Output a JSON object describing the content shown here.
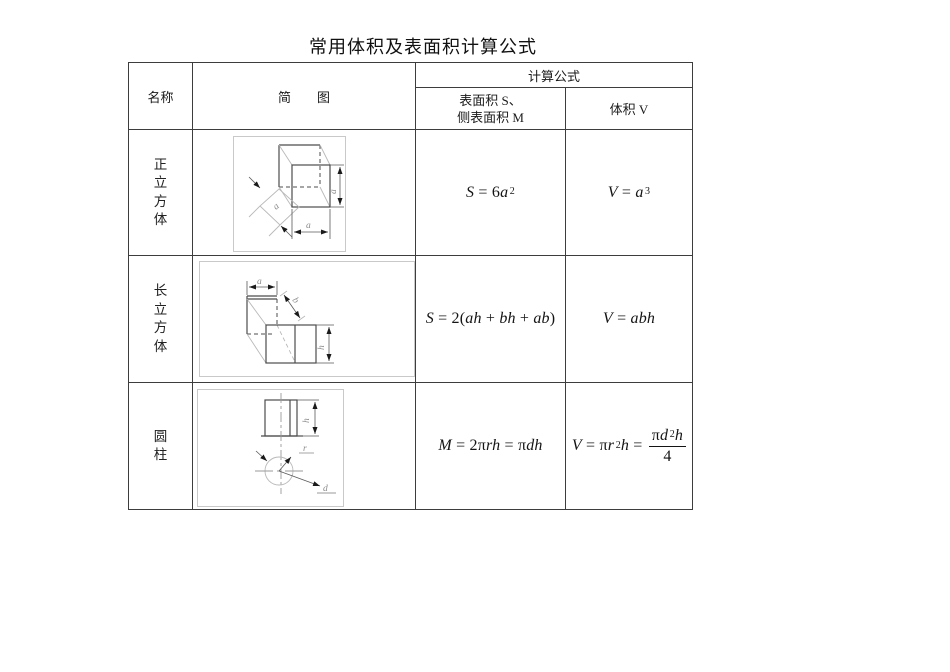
{
  "page": {
    "title": "常用体积及表面积计算公式"
  },
  "colors": {
    "grid_border": "#3d3d3d",
    "frame_border": "#c9c9c9",
    "text": "#1a1a1a"
  },
  "table": {
    "header": {
      "name": "名称",
      "diagram": "简　　图",
      "formula_group": "计算公式",
      "surface_col": "表面积 S、\n侧表面积 M",
      "volume_col": "体积 V"
    },
    "rows": [
      {
        "name": "正\n立\n方\n体",
        "labels": {
          "depth_a": "a",
          "height_a": "a",
          "width_a": "a"
        },
        "surface": [
          {
            "t": "S",
            "i": true
          },
          {
            "t": " = "
          },
          {
            "t": "6"
          },
          {
            "t": "a",
            "i": true
          },
          {
            "t": "2",
            "sup": true
          }
        ],
        "volume": [
          {
            "t": "V",
            "i": true
          },
          {
            "t": " = "
          },
          {
            "t": "a",
            "i": true
          },
          {
            "t": "3",
            "sup": true
          }
        ]
      },
      {
        "name": "长\n立\n方\n体",
        "labels": {
          "a": "a",
          "b": "b",
          "h": "h"
        },
        "surface": [
          {
            "t": "S",
            "i": true
          },
          {
            "t": " = "
          },
          {
            "t": "2("
          },
          {
            "t": "ah",
            "i": true
          },
          {
            "t": " + "
          },
          {
            "t": "bh",
            "i": true
          },
          {
            "t": " + "
          },
          {
            "t": "ab",
            "i": true
          },
          {
            "t": ")"
          }
        ],
        "volume": [
          {
            "t": "V",
            "i": true
          },
          {
            "t": " = "
          },
          {
            "t": "abh",
            "i": true
          }
        ]
      },
      {
        "name": "圆\n柱",
        "labels": {
          "h": "h",
          "r": "r",
          "d": "d"
        },
        "surface": [
          {
            "t": "M",
            "i": true
          },
          {
            "t": " = 2π"
          },
          {
            "t": "rh",
            "i": true
          },
          {
            "t": " = π"
          },
          {
            "t": "dh",
            "i": true
          }
        ],
        "volume": [
          {
            "t": "V",
            "i": true
          },
          {
            "t": " = π"
          },
          {
            "t": "r",
            "i": true
          },
          {
            "t": "2",
            "sup": true
          },
          {
            "t": "h",
            "i": true
          },
          {
            "t": " = "
          },
          {
            "frac": {
              "num": [
                {
                  "t": "π"
                },
                {
                  "t": "d",
                  "i": true
                },
                {
                  "t": "2",
                  "sup": true
                },
                {
                  "t": "h",
                  "i": true
                }
              ],
              "den": "4"
            }
          }
        ]
      }
    ]
  }
}
